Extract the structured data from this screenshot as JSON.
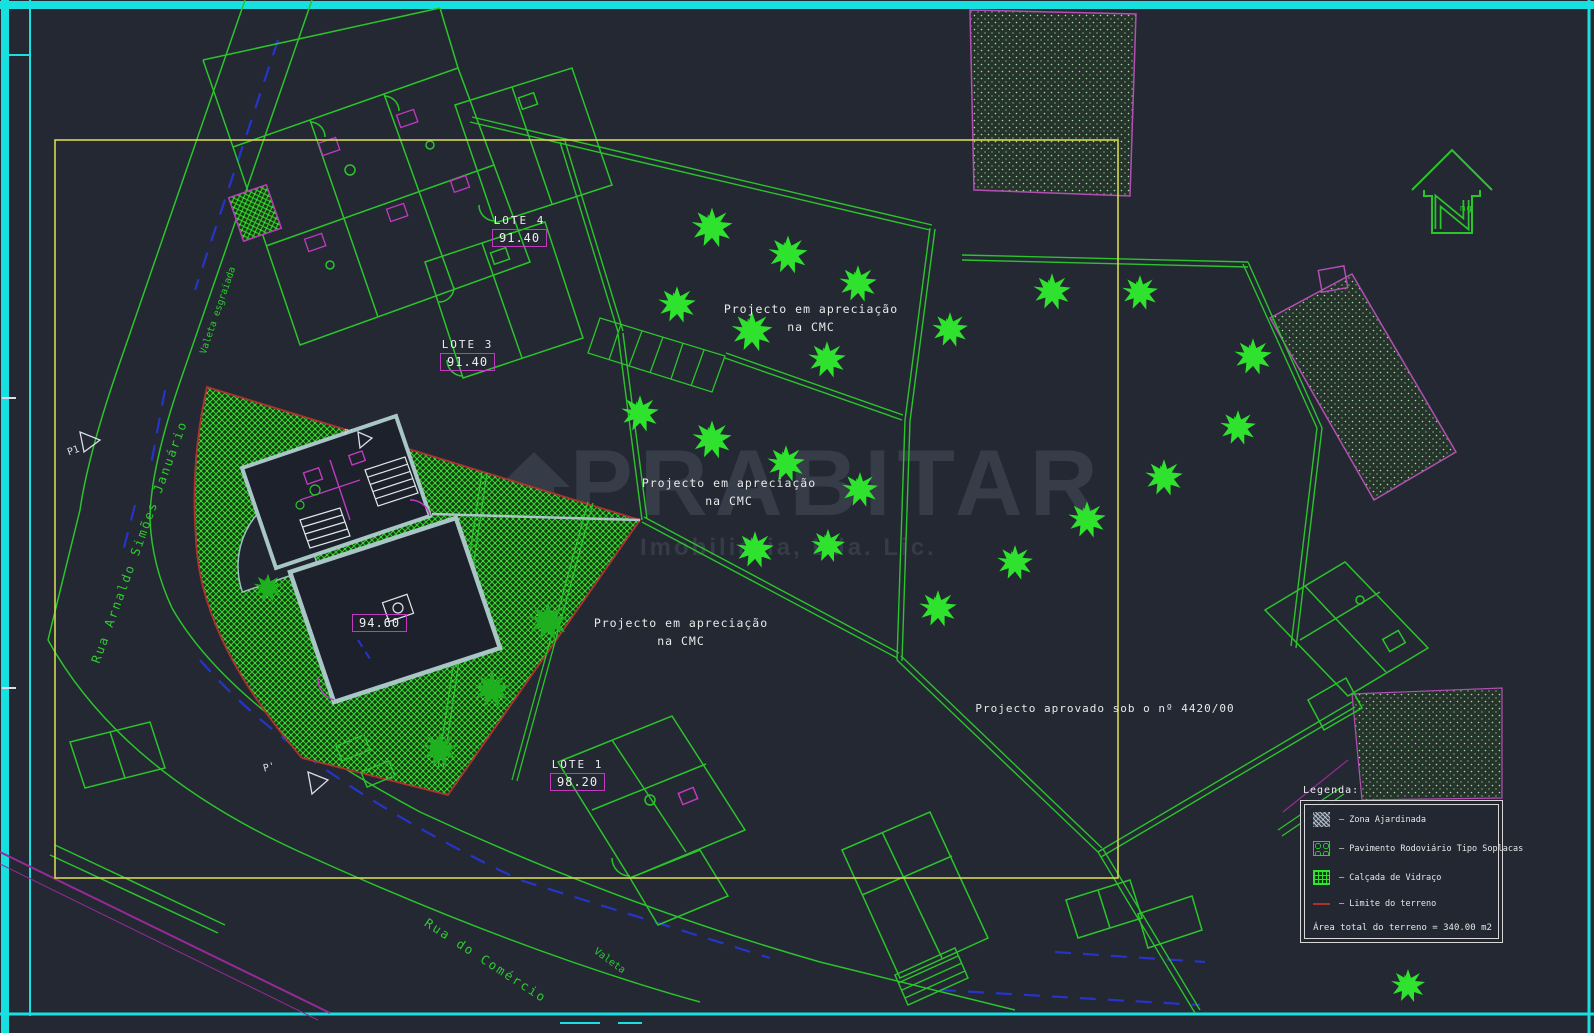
{
  "lots": {
    "lote4": {
      "name": "LOTE 4",
      "value": "91.40"
    },
    "lote3": {
      "name": "LOTE 3",
      "value": "91.40"
    },
    "lote1": {
      "name": "LOTE 1",
      "value": "98.20"
    },
    "main_house_value": "94.60"
  },
  "annotations": {
    "pending_line1": "Projecto em apreciação",
    "pending_line2": "na CMC",
    "approved": "Projecto aprovado sob o nº 4420/00",
    "street_left": "Rua Arnaldo Simões Januário",
    "street_bottom": "Rua do Comércio",
    "gutter_left": "Valeta esgraiada",
    "gutter_bottom": "Valeta",
    "section_p1": "P1",
    "section_p_prime": "P'",
    "north_initials": "mg"
  },
  "legend": {
    "title": "Legenda:",
    "items": [
      {
        "swatch": "zona-ajardinada",
        "label": "—  Zona Ajardinada"
      },
      {
        "swatch": "pavimento-soplacas",
        "label": "—  Pavimento Rodoviário Tipo Soplacas"
      },
      {
        "swatch": "calcada-vidraco",
        "label": "—  Calçada de Vidraço"
      },
      {
        "swatch": "limite-terreno",
        "label": "—  Limite do terreno"
      }
    ],
    "area_total": "Área total do terreno = 340.00 m2"
  },
  "watermark": {
    "title": "PRABITAR",
    "subtitle": "Imobiliária, Lda. Lic."
  },
  "colors": {
    "background": "#232833",
    "frame_cyan": "#19e0e0",
    "viewport_yellow": "#d6d84f",
    "line_green": "#2bc42b",
    "tree_green": "#2ee22e",
    "magenta": "#c03ac0",
    "terrain_red": "#b03030",
    "text_white": "#ededed"
  }
}
